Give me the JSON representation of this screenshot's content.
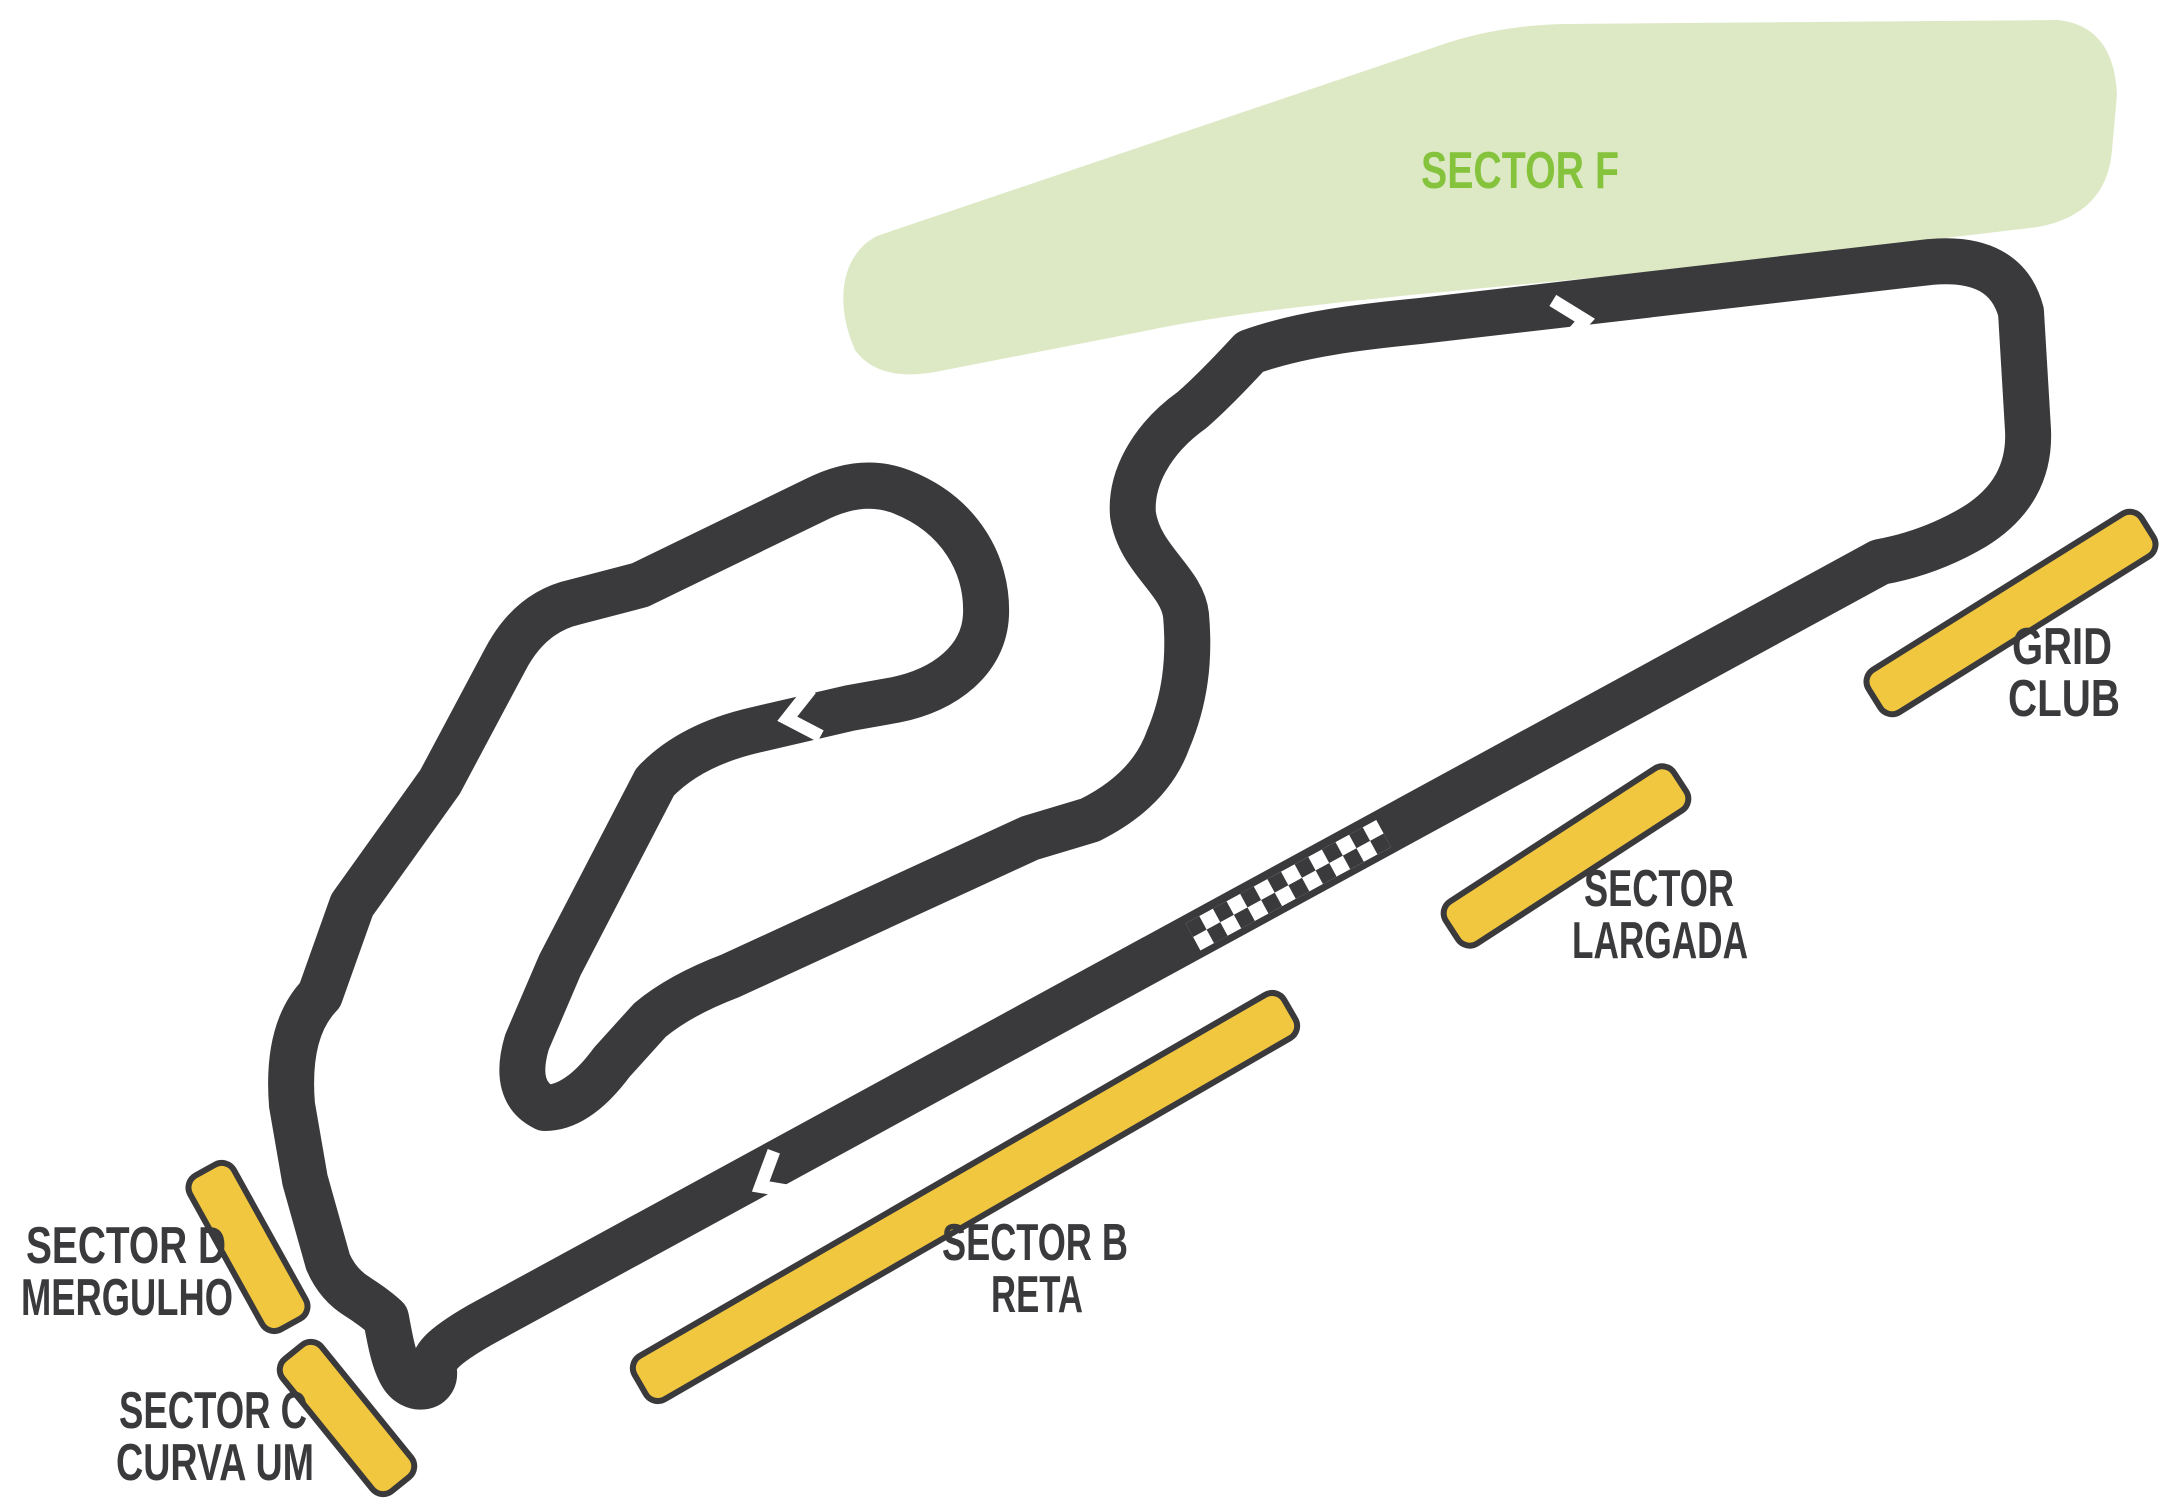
{
  "labels": {
    "sector_f": "SECTOR F",
    "grid_club": {
      "line1": "GRID",
      "line2": "CLUB"
    },
    "largada": {
      "line1": "SECTOR",
      "line2": "LARGADA"
    },
    "reta": {
      "line1": "SECTOR B",
      "line2": "RETA"
    },
    "mergulho": {
      "line1": "SECTOR D",
      "line2": "MERGULHO"
    },
    "curva_um": {
      "line1": "SECTOR C",
      "line2": "CURVA UM"
    }
  },
  "colors": {
    "background": "#ffffff",
    "track": "#3a3a3c",
    "sector_bar_fill": "#f2c740",
    "sector_bar_stroke": "#3a3a3c",
    "zone_green_fill": "#dde9c5",
    "zone_green_text": "#85c33d",
    "label_text": "#3a3a3c",
    "start_finish": "checkered-white-on-dark"
  },
  "track": {
    "direction_arrow_count": 3,
    "has_start_finish_checker": true
  }
}
